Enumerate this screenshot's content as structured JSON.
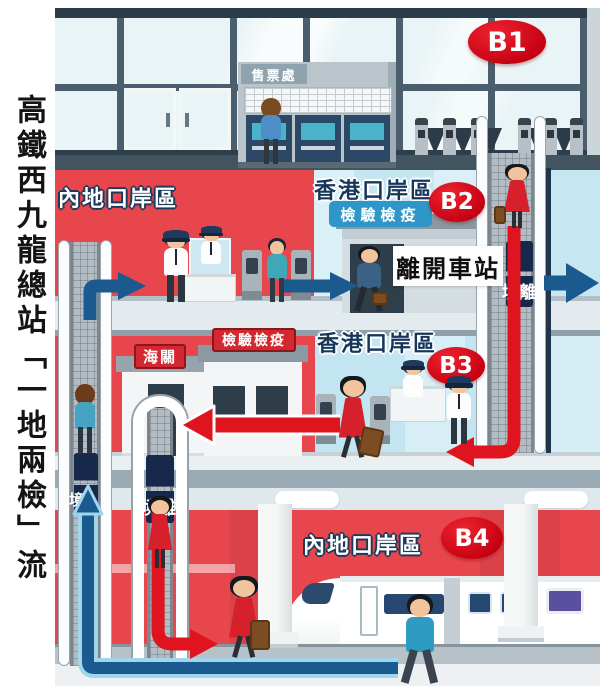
{
  "title": {
    "text": "高鐵西九龍總站「一地兩檢」流程"
  },
  "colors": {
    "mainland_zone_red": "#e8464d",
    "hk_zone_blue": "#c6e7f2",
    "departure_path_red": "#e0141f",
    "arrival_path_blue": "#1a5a8e",
    "arrival_path_casing": "#9fd6ec",
    "level_badge_red": "#c30011",
    "quarantine_badge_blue": "#2f96c9",
    "sign_red": "#d32830"
  },
  "b1": {
    "badge": "B1",
    "ticket_office": "售票處"
  },
  "b2": {
    "badge": "B2",
    "mainland_zone": "內地口岸區",
    "hk_zone": "香港口岸區",
    "quarantine": "檢驗檢疫",
    "leave_station": "離開車站",
    "escalator_departure": "離境"
  },
  "b3": {
    "badge": "B3",
    "customs": "海關",
    "quarantine": "檢驗檢疫",
    "hk_zone": "香港口岸區",
    "escalator_departure": "離境"
  },
  "b4": {
    "badge": "B4",
    "mainland_zone": "內地口岸區",
    "escalator_arrival": "入境"
  }
}
